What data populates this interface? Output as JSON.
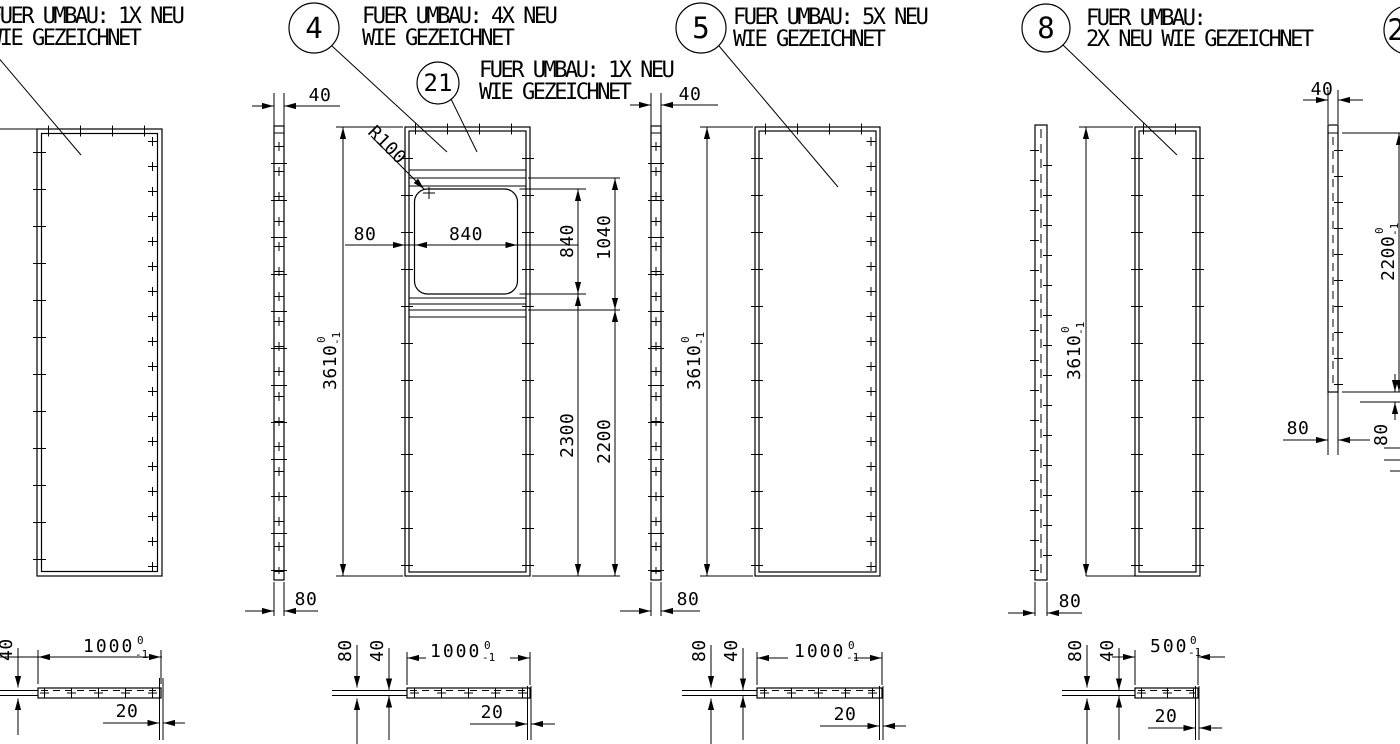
{
  "drawing": {
    "background": "#ffffff",
    "line_color": "#000000",
    "language": "de"
  },
  "callouts": {
    "left": {
      "note1": "FUER UMBAU: 1X NEU",
      "note2": "WIE GEZEICHNET"
    },
    "b4": {
      "num": "4",
      "note1": "FUER UMBAU: 4X NEU",
      "note2": "WIE GEZEICHNET"
    },
    "b21": {
      "num": "21",
      "note1": "FUER UMBAU: 1X NEU",
      "note2": "WIE GEZEICHNET"
    },
    "b5": {
      "num": "5",
      "note1": "FUER UMBAU: 5X NEU",
      "note2": "WIE GEZEICHNET"
    },
    "b8": {
      "num": "8",
      "note1": "FUER UMBAU:",
      "note2": "2X NEU WIE GEZEICHNET"
    },
    "b2": {
      "num": "2"
    }
  },
  "dims": {
    "d20": "20",
    "d40": "40",
    "d80": "80",
    "d840": "840",
    "d1040": "1040",
    "d2200": "2200",
    "d2300": "2300",
    "d3610": "3610",
    "d1000": "1000",
    "d500": "500",
    "tolPlus": "0",
    "tolMinus": "-1",
    "radius": "R100"
  }
}
